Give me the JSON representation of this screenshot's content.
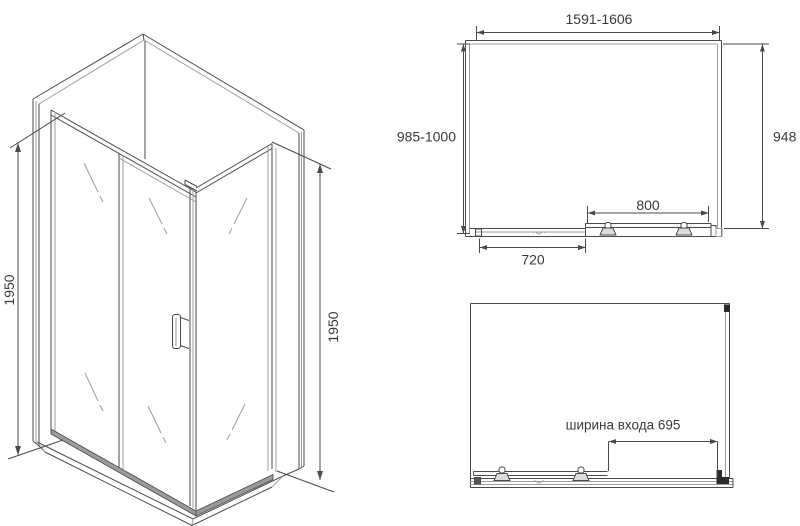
{
  "colors": {
    "line": "#4a4a4a",
    "line_light": "#9e9e9e",
    "dark": "#2b2b2b",
    "text": "#3a3a3a",
    "band_fill": "#9a9a9a",
    "background": "#ffffff"
  },
  "iso_view": {
    "height_left": "1950",
    "height_right": "1950"
  },
  "plan_view": {
    "width_range": "1591-1606",
    "depth_range": "985-1000",
    "side_panel_depth": "948",
    "door_width": "800",
    "fixed_panel_width": "720"
  },
  "front_view": {
    "entrance_width_label": "ширина входа 695"
  }
}
